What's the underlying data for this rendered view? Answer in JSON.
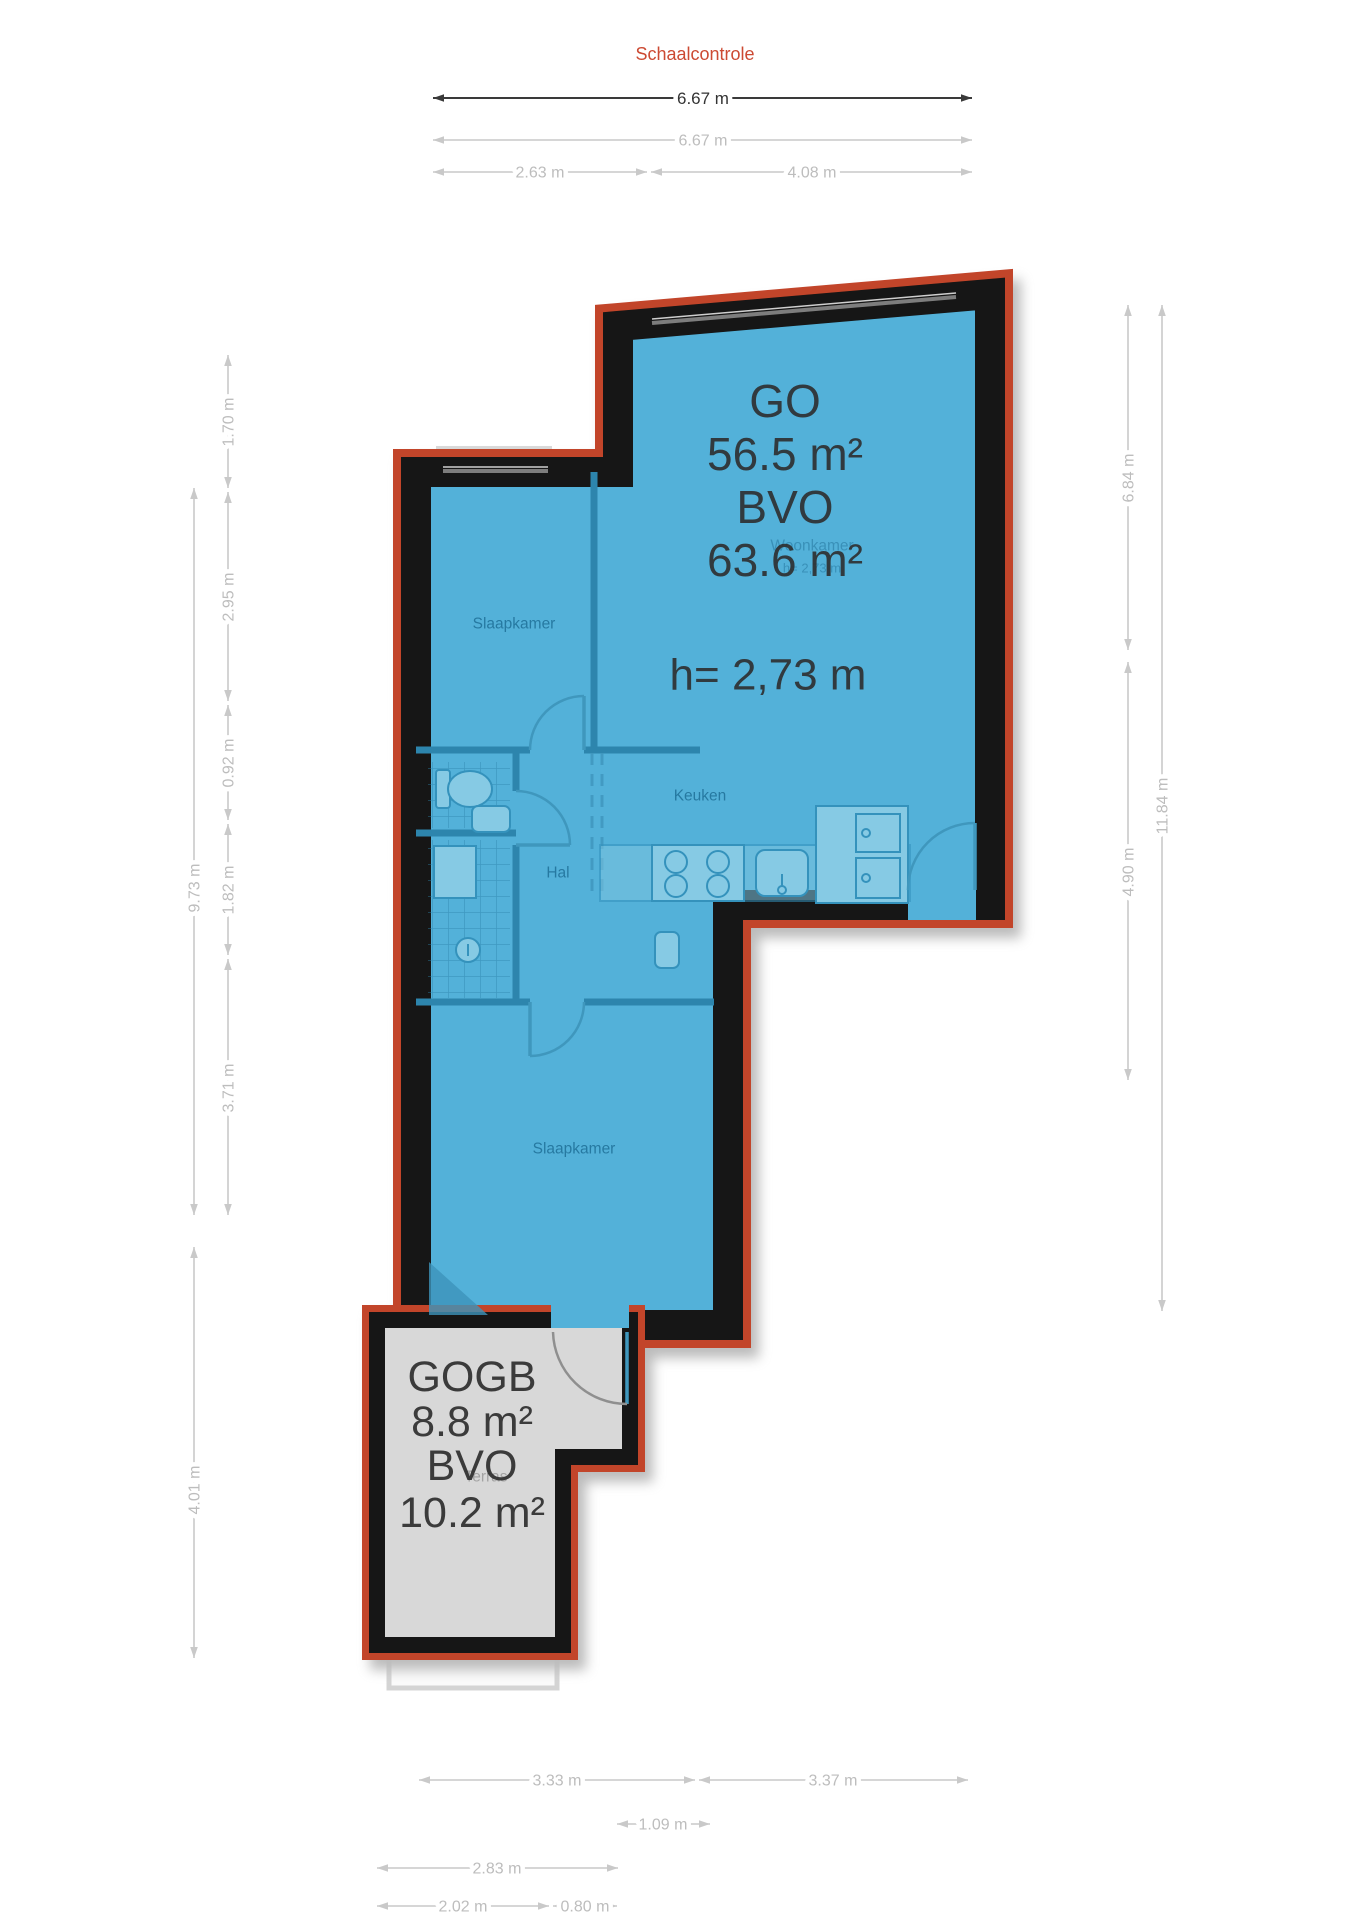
{
  "title": "Schaalcontrole",
  "plan": {
    "go_label": "GO",
    "go_value": "56.5 m²",
    "bvo_label": "BVO",
    "bvo_value": "63.6 m²",
    "ceiling_height": "h= 2,73 m",
    "gogb_label": "GOGB",
    "gogb_value": "8.8 m²",
    "gogb_bvo_label": "BVO",
    "gogb_bvo_value": "10.2 m²",
    "rooms": {
      "bedroom_top": "Slaapkamer",
      "living": "Woonkamer",
      "living_height": "h= 2,73 m",
      "kitchen": "Keuken",
      "hall": "Hal",
      "bedroom_bottom": "Slaapkamer",
      "terrace": "Terras"
    }
  },
  "dimensions": {
    "scale_bar": "6.67 m",
    "top": {
      "total": "6.67 m",
      "left": "2.63 m",
      "right": "4.08 m"
    },
    "left": {
      "seg1": "1.70 m",
      "seg2": "2.95 m",
      "seg3": "0.92 m",
      "seg4": "1.82 m",
      "seg5": "3.71 m",
      "outer": "9.73 m",
      "terrace": "4.01 m"
    },
    "right": {
      "upper": "6.84 m",
      "lower": "4.90 m",
      "outer": "11.84 m"
    },
    "bottom": {
      "row1_left": "3.33 m",
      "row1_right": "3.37 m",
      "row2": "1.09 m",
      "row3": "2.83 m",
      "row4_left": "2.02 m",
      "row4_right": "0.80 m"
    }
  },
  "colors": {
    "accent": "#cc4a33",
    "outline": "#c2452a",
    "wall": "#131313",
    "floor": "#53b1d9",
    "terrace_floor": "#d8d8d8",
    "dim_line": "#c9c9c9",
    "text_dark": "#2e2e2e"
  }
}
